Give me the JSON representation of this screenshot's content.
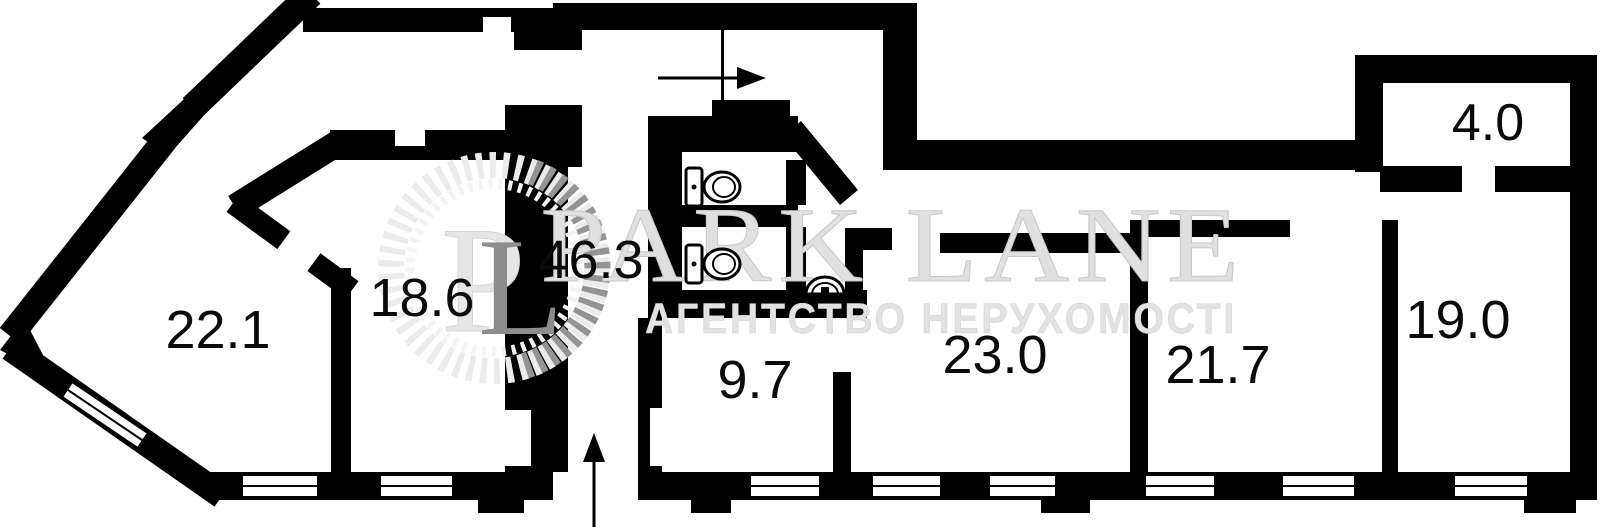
{
  "plan": {
    "type": "apartment-floor-plan",
    "rooms": [
      {
        "id": "room-22-1",
        "area_label": "22.1"
      },
      {
        "id": "room-18-6",
        "area_label": "18.6"
      },
      {
        "id": "hall-46-3",
        "area_label": "46.3"
      },
      {
        "id": "room-9-7",
        "area_label": "9.7"
      },
      {
        "id": "room-23-0",
        "area_label": "23.0"
      },
      {
        "id": "room-21-7",
        "area_label": "21.7"
      },
      {
        "id": "room-19-0",
        "area_label": "19.0"
      },
      {
        "id": "balcony-4-0",
        "area_label": "4.0"
      }
    ],
    "fixtures": [
      "toilet",
      "toilet",
      "sink"
    ],
    "colors": {
      "wall": "#000000",
      "background": "#ffffff",
      "label": "#0a0a0a",
      "watermark_light": "#e6e6e6",
      "watermark_dark": "#8d8d8d"
    }
  },
  "watermark": {
    "brand_display": "PARK LANE",
    "monogram_p": "P",
    "monogram_l": "L",
    "tagline": "АГЕНТСТВО НЕРУХОМОСТІ"
  }
}
